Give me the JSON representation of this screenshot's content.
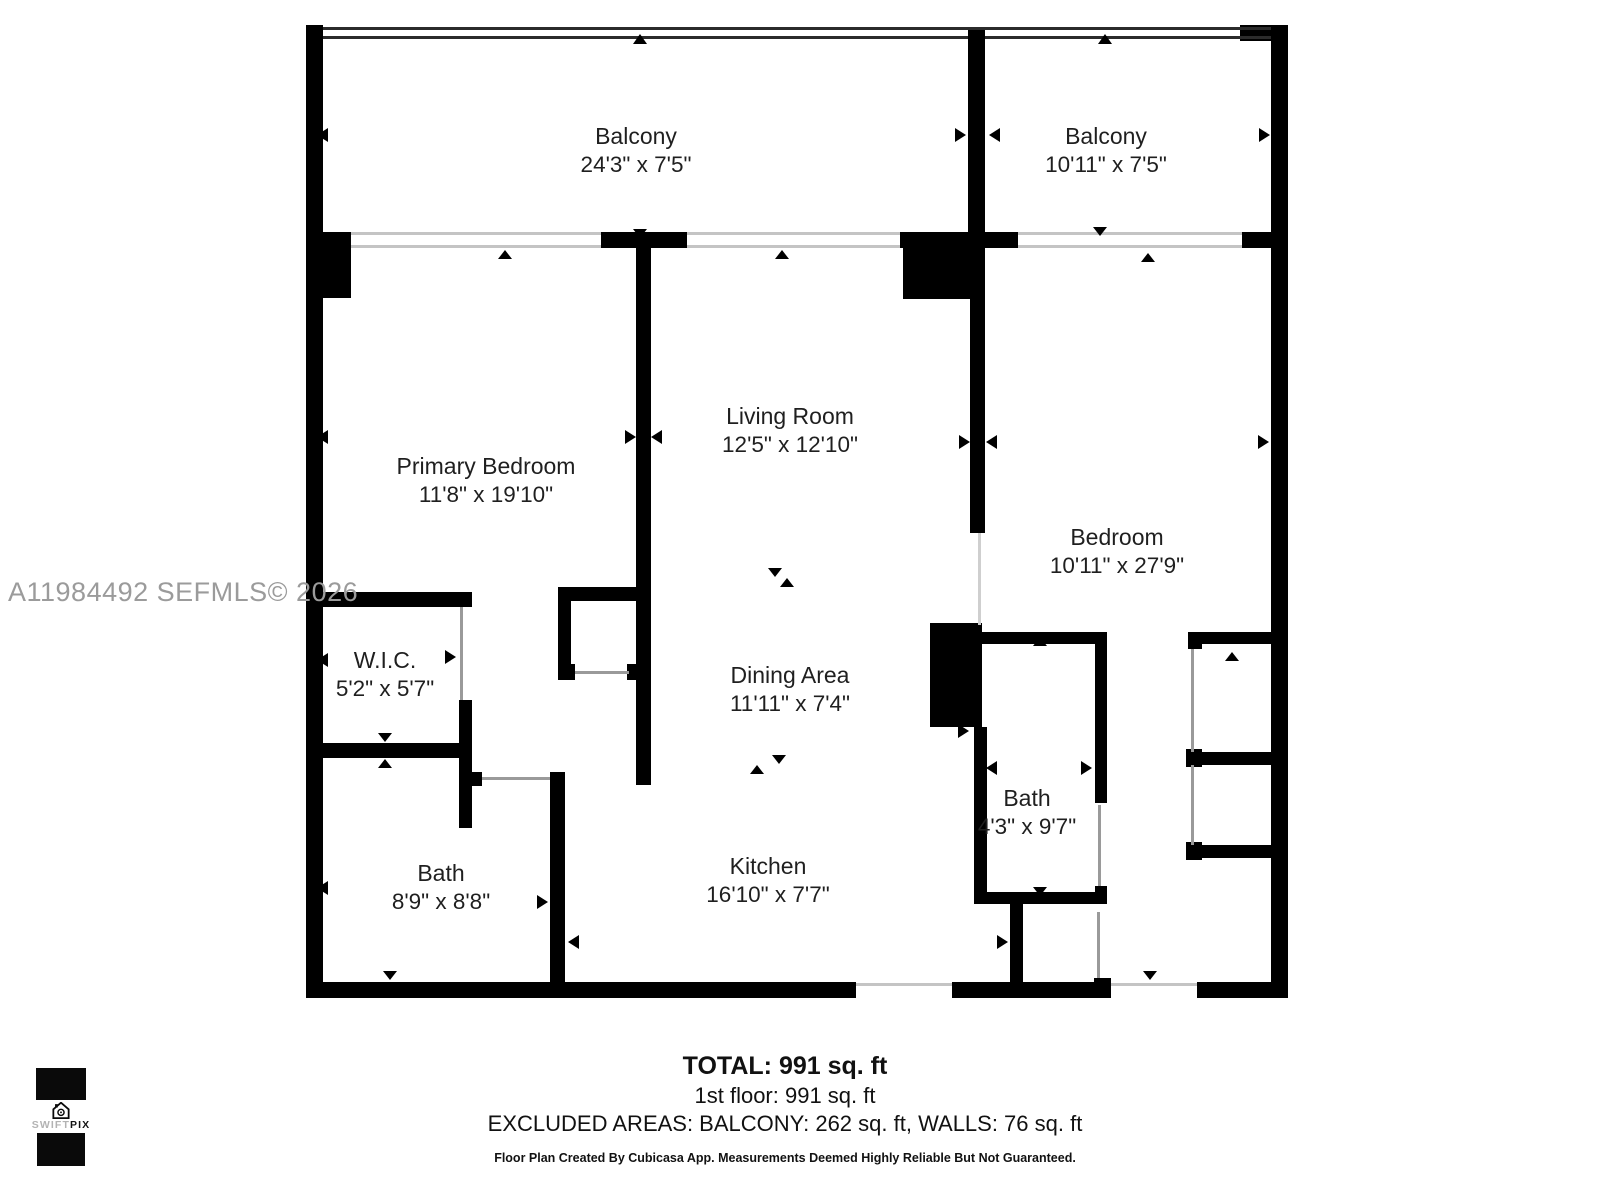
{
  "watermark": "A11984492  SEFMLS© 2026",
  "rooms": {
    "balcony1": {
      "name": "Balcony",
      "dims": "24'3\" x 7'5\""
    },
    "balcony2": {
      "name": "Balcony",
      "dims": "10'11\" x 7'5\""
    },
    "primary_bedroom": {
      "name": "Primary Bedroom",
      "dims": "11'8\" x 19'10\""
    },
    "living_room": {
      "name": "Living Room",
      "dims": "12'5\" x 12'10\""
    },
    "bedroom": {
      "name": "Bedroom",
      "dims": "10'11\" x 27'9\""
    },
    "wic": {
      "name": "W.I.C.",
      "dims": "5'2\" x 5'7\""
    },
    "dining_area": {
      "name": "Dining Area",
      "dims": "11'11\" x 7'4\""
    },
    "bath1": {
      "name": "Bath",
      "dims": "8'9\" x 8'8\""
    },
    "kitchen": {
      "name": "Kitchen",
      "dims": "16'10\" x 7'7\""
    },
    "bath2": {
      "name": "Bath",
      "dims": "4'3\" x 9'7\""
    }
  },
  "summary": {
    "total": "TOTAL: 991 sq. ft",
    "floor1": "1st floor: 991 sq. ft",
    "excluded": "EXCLUDED AREAS: BALCONY: 262 sq. ft, WALLS: 76 sq. ft",
    "disclaimer": "Floor Plan Created By Cubicasa App. Measurements Deemed Highly Reliable But Not Guaranteed."
  },
  "logo": {
    "brand_part1": "SWIFT",
    "brand_part2": "PIX"
  },
  "colors": {
    "wall": "#000000",
    "watermark": "#9b9b9b",
    "text": "#1f1f1f"
  }
}
